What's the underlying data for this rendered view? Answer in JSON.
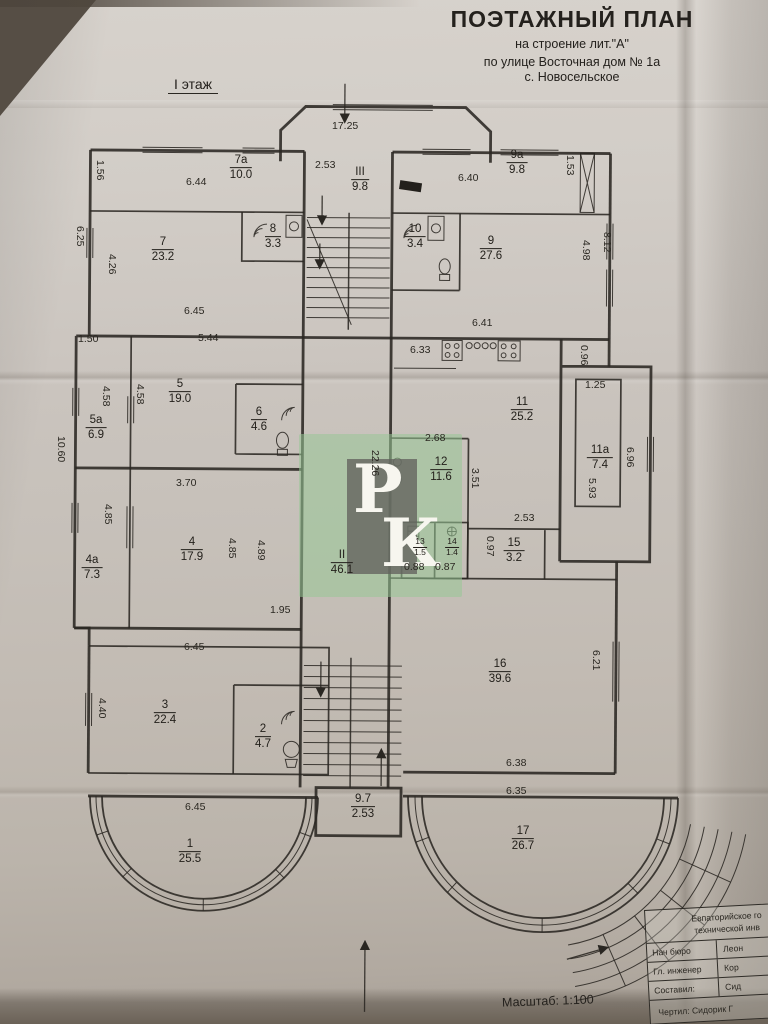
{
  "header": {
    "title": "ПОЭТАЖНЫЙ ПЛАН",
    "line1": "на строение лит.\"А\"",
    "line2": "по улице  Восточная  дом   № 1а",
    "line3": "с.  Новосельское",
    "floor": "I этаж"
  },
  "scale_label": "Масштаб: 1:100",
  "stamp": {
    "top": "Р",
    "bottom": "К"
  },
  "rooms": [
    {
      "n": "1",
      "a": "25.5"
    },
    {
      "n": "2",
      "a": "4.7"
    },
    {
      "n": "3",
      "a": "22.4"
    },
    {
      "n": "4",
      "a": "17.9"
    },
    {
      "n": "4а",
      "a": "7.3"
    },
    {
      "n": "5",
      "a": "19.0"
    },
    {
      "n": "5а",
      "a": "6.9"
    },
    {
      "n": "6",
      "a": "4.6"
    },
    {
      "n": "7",
      "a": "23.2"
    },
    {
      "n": "7а",
      "a": "10.0"
    },
    {
      "n": "8",
      "a": "3.3"
    },
    {
      "n": "9",
      "a": "27.6"
    },
    {
      "n": "9а",
      "a": "9.8"
    },
    {
      "n": "10",
      "a": "3.4"
    },
    {
      "n": "11",
      "a": "25.2"
    },
    {
      "n": "11а",
      "a": "7.4"
    },
    {
      "n": "12",
      "a": "11.6"
    },
    {
      "n": "13",
      "a": "1.5"
    },
    {
      "n": "14",
      "a": "1.4"
    },
    {
      "n": "15",
      "a": "3.2"
    },
    {
      "n": "16",
      "a": "39.6"
    },
    {
      "n": "17",
      "a": "26.7"
    },
    {
      "n": "II",
      "a": "46.1"
    },
    {
      "n": "III",
      "a": "9.8"
    },
    {
      "n": "9.7",
      "a": "2.53"
    }
  ],
  "dims": [
    "17.25",
    "2.53",
    "6.44",
    "6.40",
    "1.56",
    "1.53",
    "6.25",
    "4.26",
    "4.98",
    "8.12",
    "6.45",
    "6.41",
    "6.33",
    "0.96",
    "1.50",
    "5.44",
    "4.58",
    "4.58",
    "10.60",
    "3.70",
    "1.25",
    "2.68",
    "3.51",
    "6.96",
    "5.93",
    "22.26",
    "4.85",
    "4.85",
    "4.89",
    "2.53",
    "0.97",
    "0.88",
    "0.87",
    "1.95",
    "6.45",
    "6.21",
    "4.40",
    "6.38",
    "6.35",
    "6.45"
  ],
  "table": {
    "h1": "Евпаторийское го",
    "h2": "технической инв",
    "rows": [
      {
        "label": "Нач бюро",
        "value": "Леон"
      },
      {
        "label": "Гл. инженер",
        "value": "Кор"
      },
      {
        "label": "Составил:",
        "value": "Сид"
      }
    ],
    "footer": "Чертил: Сидорик Г"
  }
}
